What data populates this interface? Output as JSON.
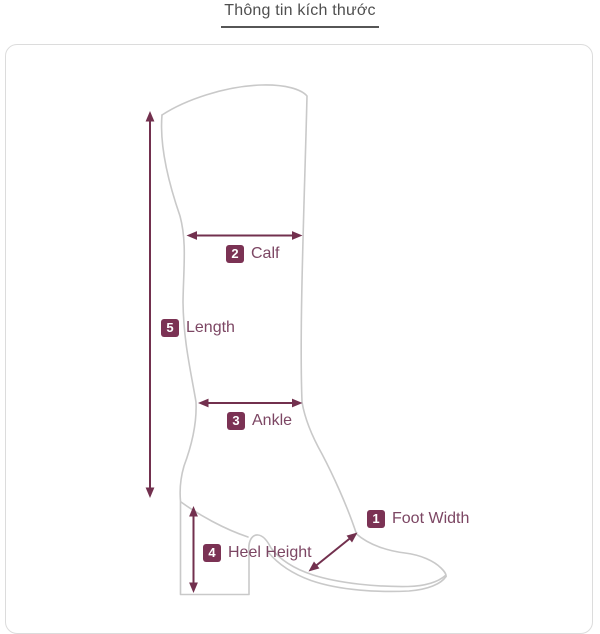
{
  "title": "Thông tin kích thước",
  "measurements": {
    "foot_width": {
      "number": "1",
      "label": "Foot Width"
    },
    "calf": {
      "number": "2",
      "label": "Calf"
    },
    "ankle": {
      "number": "3",
      "label": "Ankle"
    },
    "heel_height": {
      "number": "4",
      "label": "Heel Height"
    },
    "length": {
      "number": "5",
      "label": "Length"
    }
  },
  "diagram": {
    "subject": "knee-high heeled boot outline",
    "style": "light gray line drawing with plum measurement arrows"
  },
  "colors": {
    "accent_arrow": "#72304E",
    "badge_background": "#7B3254",
    "badge_number": "#FFFFFF",
    "label_text": "#7C4663",
    "boot_outline": "#C9C9C9",
    "panel_border": "#DCDCDC",
    "title_text": "#4F4F4F",
    "title_underline": "#565656",
    "background": "#FFFFFF"
  }
}
